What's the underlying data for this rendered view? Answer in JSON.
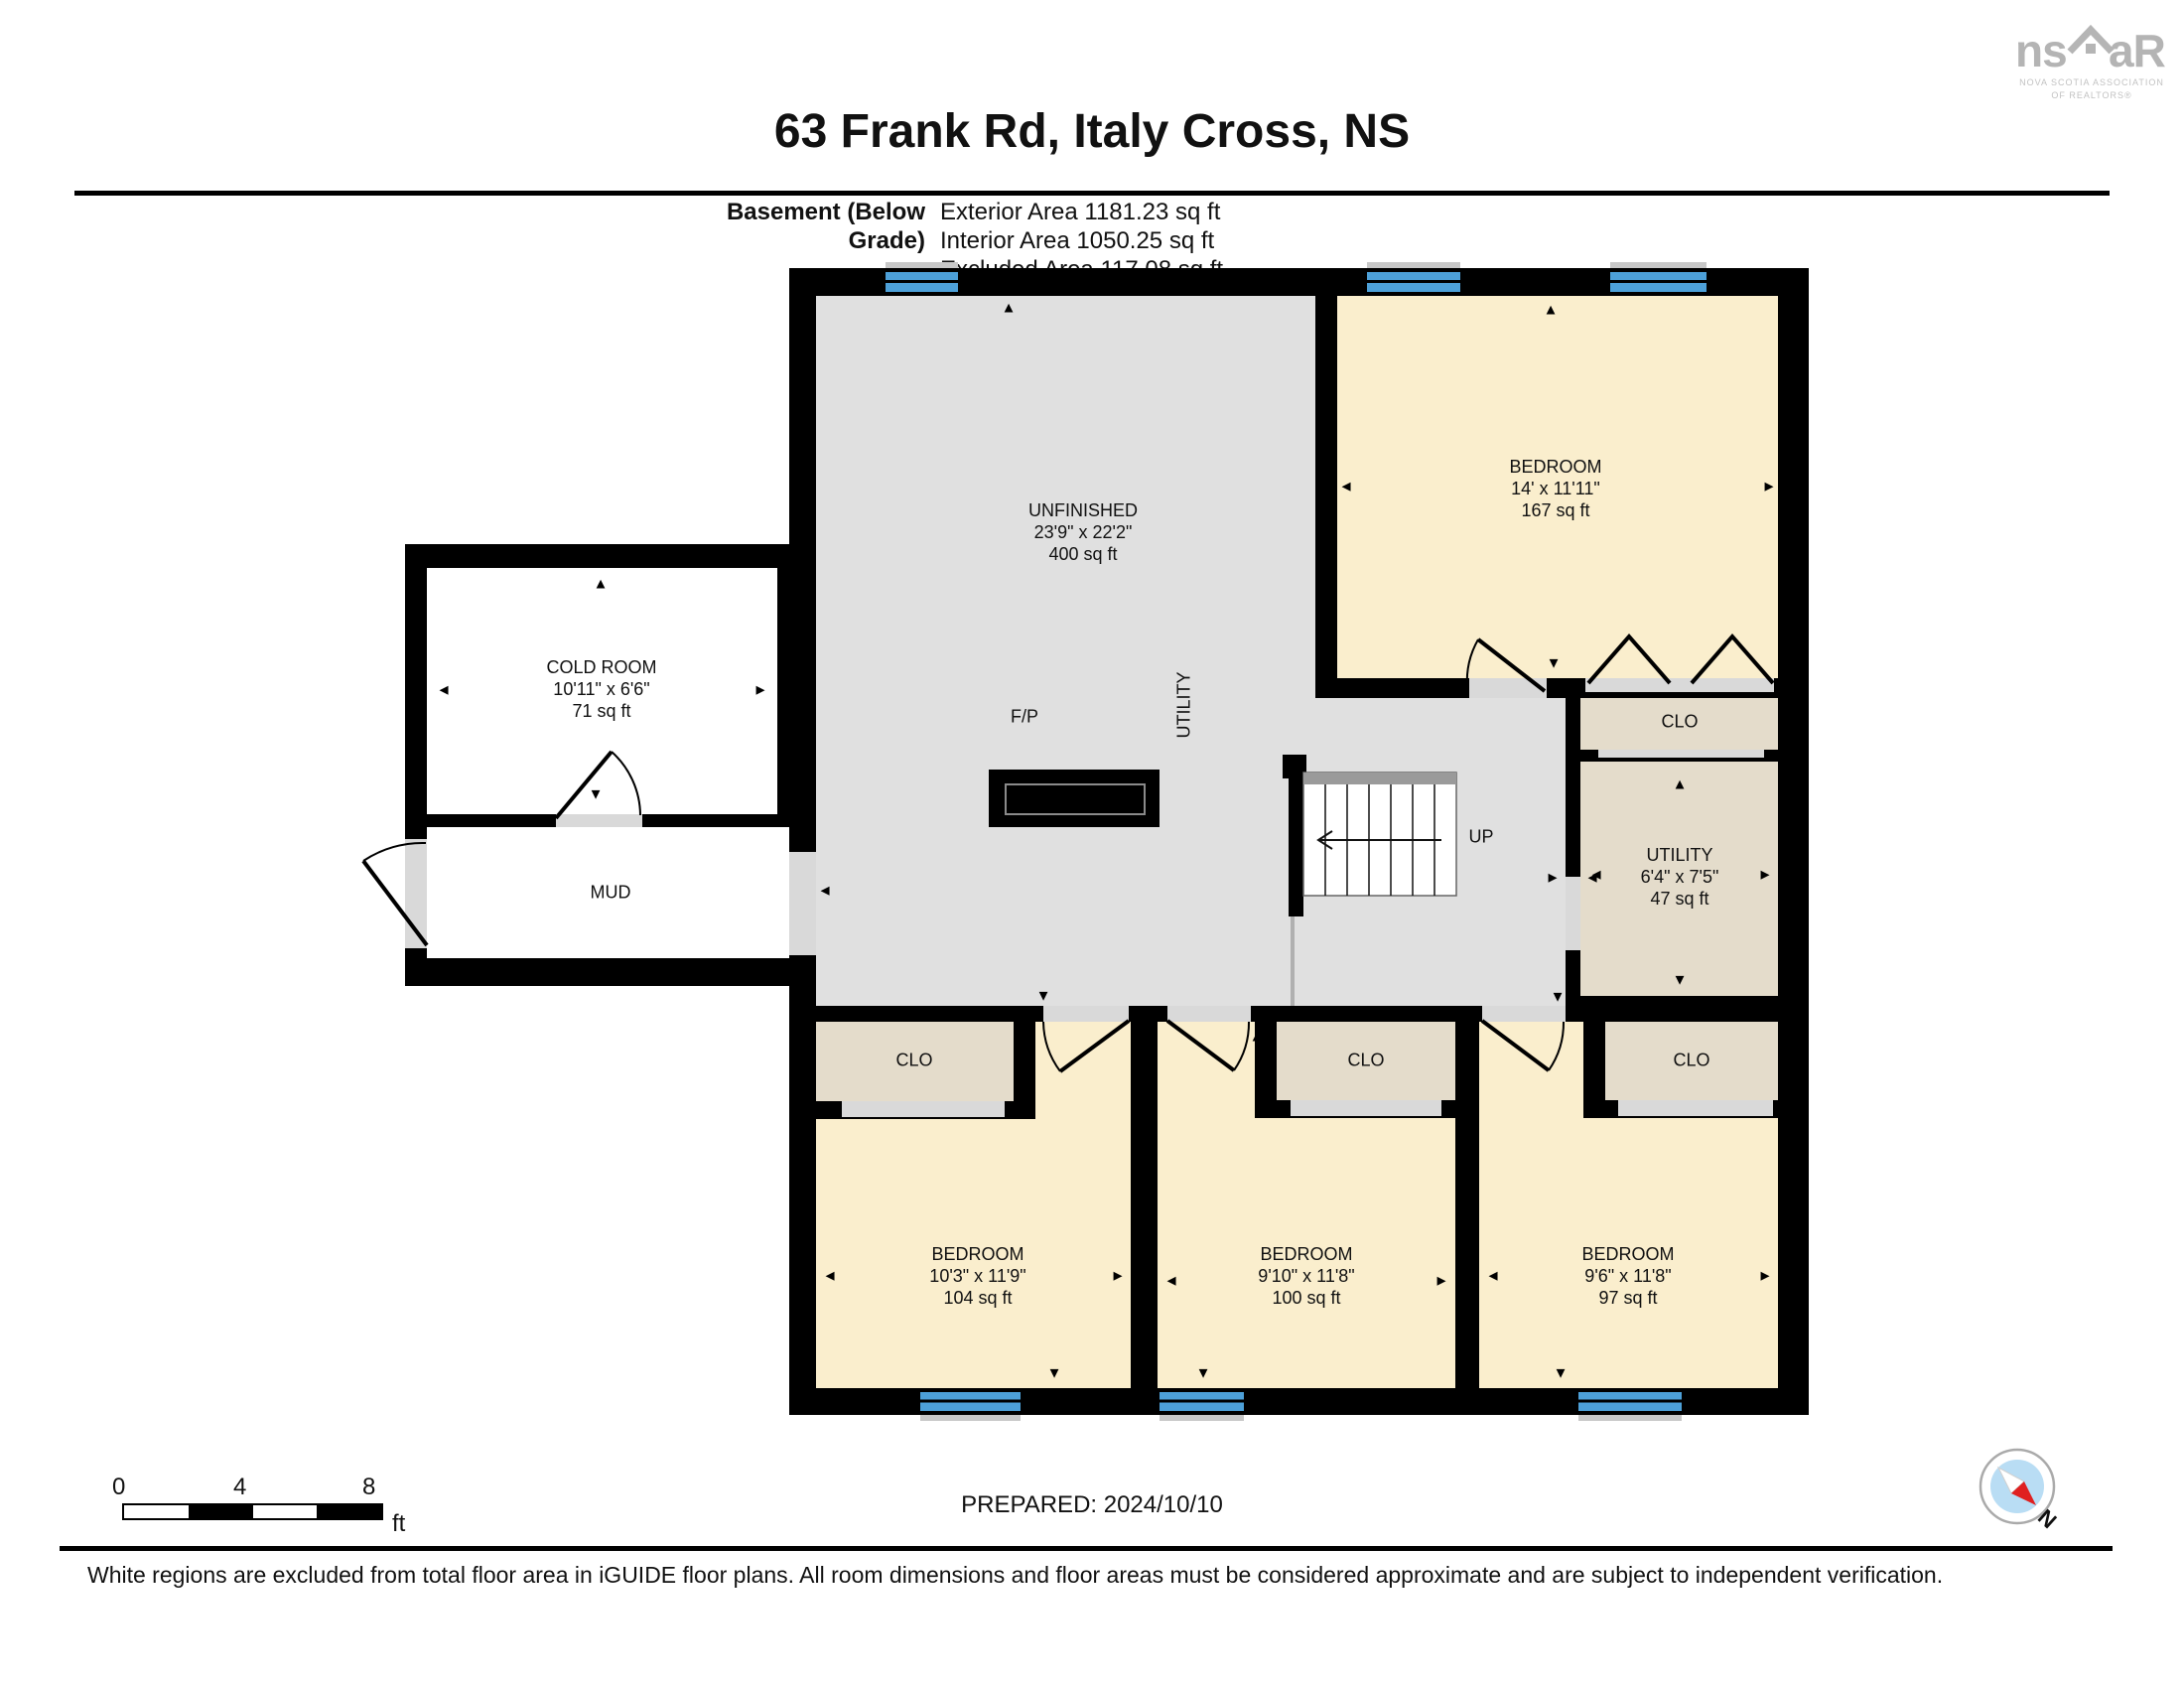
{
  "header": {
    "title": "63 Frank Rd, Italy Cross, NS",
    "floor_label": "Basement (Below Grade)",
    "exterior_area": "Exterior Area 1181.23 sq ft",
    "interior_area": "Interior Area 1050.25 sq ft",
    "excluded_area": "Excluded Area 117.08 sq ft"
  },
  "logo": {
    "left_text": "ns",
    "right_text": "aR",
    "caption_line1": "NOVA SCOTIA ASSOCIATION",
    "caption_line2": "OF REALTORS®"
  },
  "rooms": {
    "unfinished": {
      "name": "UNFINISHED",
      "dims": "23'9\" x 22'2\"",
      "area": "400 sq ft"
    },
    "cold_room": {
      "name": "COLD ROOM",
      "dims": "10'11\" x 6'6\"",
      "area": "71 sq ft"
    },
    "mud": {
      "name": "MUD"
    },
    "bedroom_top": {
      "name": "BEDROOM",
      "dims": "14' x 11'11\"",
      "area": "167 sq ft"
    },
    "clo_top": {
      "name": "CLO"
    },
    "utility_room": {
      "name": "UTILITY",
      "dims": "6'4\" x 7'5\"",
      "area": "47 sq ft"
    },
    "utility_area": {
      "name": "UTILITY"
    },
    "fireplace": {
      "name": "F/P"
    },
    "stairs": {
      "name": "UP"
    },
    "bedroom_1": {
      "name": "BEDROOM",
      "dims": "10'3\" x 11'9\"",
      "area": "104 sq ft"
    },
    "bedroom_2": {
      "name": "BEDROOM",
      "dims": "9'10\" x 11'8\"",
      "area": "100 sq ft"
    },
    "bedroom_3": {
      "name": "BEDROOM",
      "dims": "9'6\" x 11'8\"",
      "area": "97 sq ft"
    },
    "clo_1": {
      "name": "CLO"
    },
    "clo_2": {
      "name": "CLO"
    },
    "clo_3": {
      "name": "CLO"
    }
  },
  "footer": {
    "prepared": "PREPARED: 2024/10/10",
    "disclaimer": "White regions are excluded from total floor area in iGUIDE floor plans. All room dimensions and floor areas must be considered approximate and are subject to independent verification.",
    "scale_0": "0",
    "scale_4": "4",
    "scale_8": "8",
    "scale_unit": "ft",
    "north_label": "N"
  },
  "icons": {
    "arrow_up": "▲",
    "arrow_down": "▼",
    "arrow_left": "◄",
    "arrow_right": "►"
  },
  "colors": {
    "bedroom_fill": "#faeecd",
    "unfinished_fill": "#e0e0e0",
    "closet_fill": "#e4dccb",
    "excluded_fill": "#ffffff",
    "window_blue": "#4da0d8",
    "wall_black": "#000000",
    "door_sill": "#d9d9d9",
    "compass_red": "#e02020",
    "compass_blue": "#b9ddf4"
  }
}
